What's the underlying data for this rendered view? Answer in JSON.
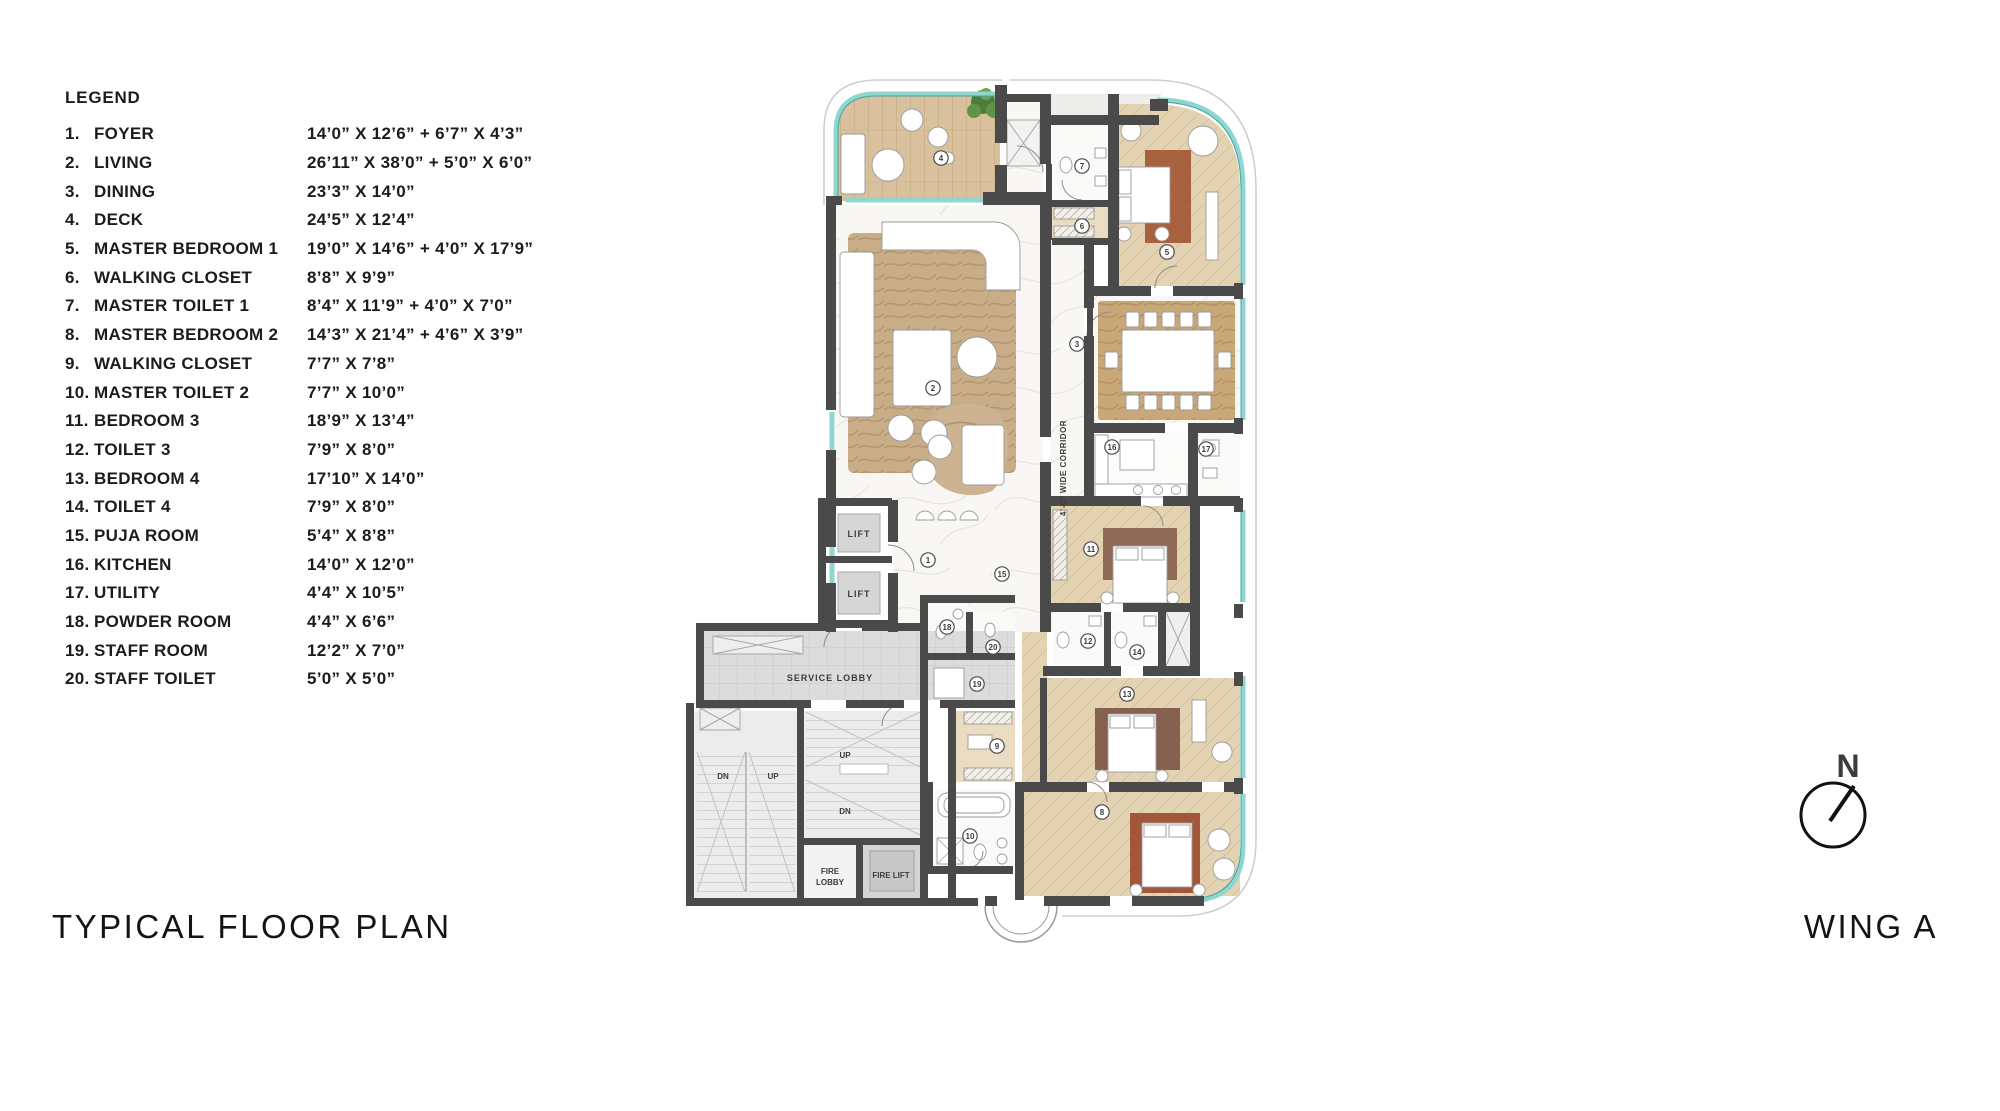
{
  "legend": {
    "title": "LEGEND",
    "items": [
      {
        "num": "1.",
        "name": "FOYER",
        "dims": "14’0” X 12’6” + 6’7” X 4’3”"
      },
      {
        "num": "2.",
        "name": "LIVING",
        "dims": "26’11” X 38’0” + 5’0” X 6’0”"
      },
      {
        "num": "3.",
        "name": "DINING",
        "dims": "23’3” X 14’0”"
      },
      {
        "num": "4.",
        "name": "DECK",
        "dims": "24’5” X 12’4”"
      },
      {
        "num": "5.",
        "name": "MASTER BEDROOM 1",
        "dims": "19’0” X 14’6” + 4’0” X 17’9”"
      },
      {
        "num": "6.",
        "name": "WALKING CLOSET",
        "dims": "8’8” X 9’9”"
      },
      {
        "num": "7.",
        "name": "MASTER TOILET 1",
        "dims": "8’4” X 11’9” + 4’0” X 7’0”"
      },
      {
        "num": "8.",
        "name": "MASTER BEDROOM 2",
        "dims": "14’3” X 21’4” + 4’6” X 3’9”"
      },
      {
        "num": "9.",
        "name": "WALKING CLOSET",
        "dims": "7’7” X 7’8”"
      },
      {
        "num": "10.",
        "name": "MASTER TOILET 2",
        "dims": "7’7” X 10’0”"
      },
      {
        "num": "11.",
        "name": "BEDROOM 3",
        "dims": "18’9” X 13’4”"
      },
      {
        "num": "12.",
        "name": "TOILET 3",
        "dims": "7’9” X 8’0”"
      },
      {
        "num": "13.",
        "name": "BEDROOM 4",
        "dims": "17’10” X 14’0”"
      },
      {
        "num": "14.",
        "name": "TOILET 4",
        "dims": "7’9” X 8’0”"
      },
      {
        "num": "15.",
        "name": "PUJA ROOM",
        "dims": "5’4” X 8’8”"
      },
      {
        "num": "16.",
        "name": "KITCHEN",
        "dims": "14’0” X 12’0”"
      },
      {
        "num": "17.",
        "name": "UTILITY",
        "dims": "4’4” X 10’5”"
      },
      {
        "num": "18.",
        "name": "POWDER ROOM",
        "dims": "4’4” X 6’6”"
      },
      {
        "num": "19.",
        "name": "STAFF ROOM",
        "dims": "12’2” X 7’0”"
      },
      {
        "num": "20.",
        "name": "STAFF TOILET",
        "dims": "5’0” X 5’0”"
      }
    ]
  },
  "plan": {
    "labels": {
      "lift": "LIFT",
      "service_lobby": "SERVICE LOBBY",
      "fire_line1": "FIRE",
      "fire_line2": "LOBBY",
      "fire_lift": "FIRE LIFT",
      "up": "UP",
      "dn": "DN",
      "corridor": "4’-0” WIDE CORRIDOR"
    },
    "room_markers": [
      {
        "n": "1",
        "x": 928,
        "y": 560
      },
      {
        "n": "2",
        "x": 933,
        "y": 388
      },
      {
        "n": "3",
        "x": 1077,
        "y": 344
      },
      {
        "n": "4",
        "x": 941,
        "y": 158
      },
      {
        "n": "5",
        "x": 1167,
        "y": 252
      },
      {
        "n": "6",
        "x": 1082,
        "y": 226
      },
      {
        "n": "7",
        "x": 1082,
        "y": 166
      },
      {
        "n": "8",
        "x": 1102,
        "y": 812
      },
      {
        "n": "9",
        "x": 997,
        "y": 746
      },
      {
        "n": "10",
        "x": 970,
        "y": 836
      },
      {
        "n": "11",
        "x": 1091,
        "y": 549
      },
      {
        "n": "12",
        "x": 1088,
        "y": 641
      },
      {
        "n": "13",
        "x": 1127,
        "y": 694
      },
      {
        "n": "14",
        "x": 1137,
        "y": 652
      },
      {
        "n": "15",
        "x": 1002,
        "y": 574
      },
      {
        "n": "16",
        "x": 1112,
        "y": 447
      },
      {
        "n": "17",
        "x": 1206,
        "y": 449
      },
      {
        "n": "18",
        "x": 947,
        "y": 627
      },
      {
        "n": "19",
        "x": 977,
        "y": 684
      },
      {
        "n": "20",
        "x": 993,
        "y": 647
      }
    ]
  },
  "footer": {
    "title": "TYPICAL FLOOR PLAN",
    "wing": "WING A"
  },
  "compass": {
    "label": "N"
  },
  "colors": {
    "wall": "#4a4a4a",
    "glass_teal": "#8fd6d1",
    "wood_deck": "#d9c19d",
    "bedroom_floor": "#e4d3b3",
    "marble": "#f8f7f4",
    "service_gray": "#dddddd",
    "rug_red": "#a3563a"
  }
}
